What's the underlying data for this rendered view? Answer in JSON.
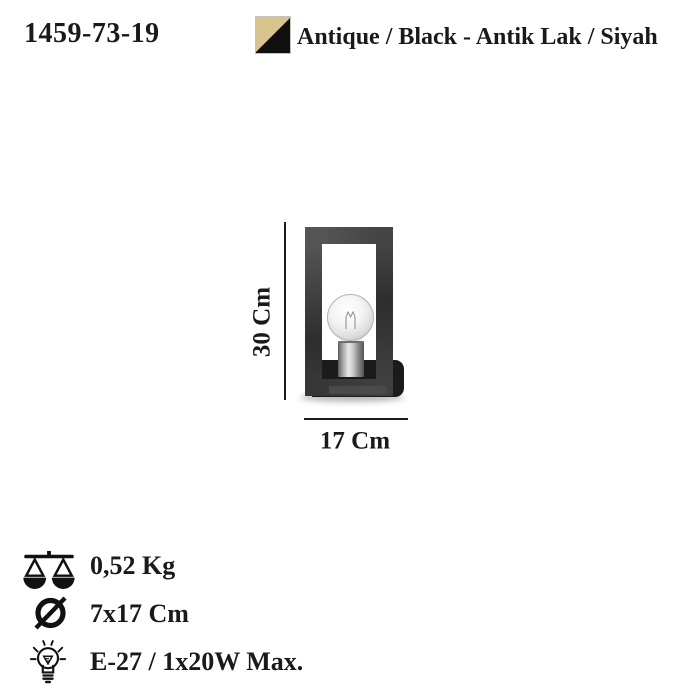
{
  "header": {
    "product_code": "1459-73-19",
    "finish_label": "Antique / Black - Antik Lak / Siyah",
    "swatch_colors": {
      "antique": "#d8c28e",
      "black": "#0f0f0f"
    }
  },
  "dimensions": {
    "height_label": "30 Cm",
    "width_label": "17 Cm"
  },
  "specs": {
    "weight": {
      "icon": "scale-icon",
      "value": "0,52 Kg"
    },
    "size": {
      "icon": "diameter-icon",
      "value": "7x17 Cm"
    },
    "socket": {
      "icon": "bulb-icon",
      "value": "E-27 / 1x20W Max."
    }
  }
}
